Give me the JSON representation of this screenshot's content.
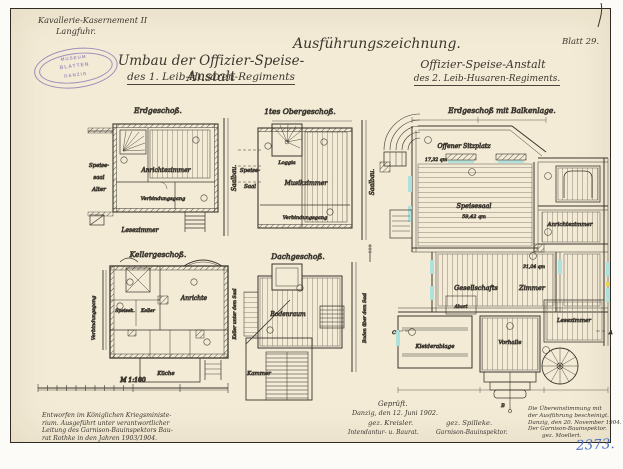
{
  "page": {
    "inventory_number": "2373.",
    "sheet_label": "Blatt 29."
  },
  "header": {
    "site_line1": "Kavallerie-Kasernement II",
    "site_line2": "Langfuhr.",
    "title_left_line1": "Umbau der Offizier-Speise-Anstalt",
    "title_left_line2": "des 1. Leib-Husaren-Regiments",
    "title_right_top": "Ausführungszeichnung.",
    "title_right_line1": "Offizier-Speise-Anstalt",
    "title_right_line2": "des 2. Leib-Husaren-Regiments."
  },
  "stamp": {
    "line_top": "MUSEUM",
    "line_mid": "BLATTEN",
    "line_bottom": "DANZIG"
  },
  "plans": {
    "erdgeschoss": {
      "title": "Erdgeschoß.",
      "label_speise": "Speise-",
      "label_saal": "saal",
      "label_alter": "Alter",
      "room_anrichte": "Anrichtezimmer",
      "room_verbindungsgang": "Verbindungsgang",
      "label_saalbau": "Saalbau.",
      "label_lesezimmer": "Lesezimmer"
    },
    "obergeschoss": {
      "title": "1tes Obergeschoß.",
      "label_speise": "Speise-",
      "label_saal": "Saal",
      "room_loggia": "Loggia",
      "room_musikzimmer": "Musikzimmer",
      "room_verbindungsgang": "Verbindungsgang",
      "label_saalbau": "Saalbau."
    },
    "kellergeschoss": {
      "title": "Kellergeschoß.",
      "label_verbindungsgang": "Verbindungsgang",
      "room_speisekammer": "Speisek.",
      "room_keller": "Keller",
      "room_anrichte": "Anrichte",
      "label_keller_saal": "Keller unter dem Saal",
      "room_kueche": "Küche"
    },
    "dachgeschoss": {
      "title": "Dachgeschoß.",
      "room_bodenraum": "Bodenraum",
      "label_boden_saal": "Boden über dem Saal",
      "room_kammer": "Kammer"
    },
    "hauptplan": {
      "title": "Erdgeschoß mit Balkenlage.",
      "room_sitzplatz": "Offener Sitzplatz",
      "area_sitzplatz": "17,32 qm",
      "room_speisesaal": "Speisesaal",
      "area_speisesaal": "59,42 qm",
      "room_anrichtezimmer": "Anrichtezimmer",
      "room_gesellschaft_1": "Gesellschafts",
      "room_gesellschaft_2": "Zimmer",
      "area_gesellschaft": "31,04 qm",
      "room_abort": "Abort",
      "room_vorhalle": "Vorhalle",
      "room_lesezimmer": "Lesezimmer",
      "room_kleiderablage": "Kleiderablage",
      "section_a": "A",
      "section_b": "B",
      "section_c": "C"
    }
  },
  "scale_bar": {
    "label": "M 1:100"
  },
  "footer": {
    "note_line1": "Entworfen im Königlichen Kriegsministe-",
    "note_line2": "rium. Ausgeführt unter verantwortlicher",
    "note_line3": "Leitung des Garnison-Bauinspektors Bau-",
    "note_line4": "rat Rothke in den Jahren 1903/1904.",
    "approval_title": "Geprüft.",
    "approval_place_date": "Danzig, den 12. Juni 1902.",
    "signature_1": "gez. Kreisler.",
    "signature_1_role": "Intendantur- u. Baurat.",
    "signature_2": "gez. Spilleke.",
    "signature_2_role": "Garnison-Bauinspektor.",
    "cert_line1": "Die Übereinstimmung mit",
    "cert_line2": "der Ausführung bescheinigt.",
    "cert_line3": "Danzig, den 20. November 1904.",
    "cert_line4": "Der Garnison-Bauinspektor.",
    "cert_line5": "gez. Moellert."
  },
  "colors": {
    "paper": "#f3ebd6",
    "ink": "#3b362e",
    "stamp_purple": "#8a76b4",
    "inventory_blue": "#4b6fc2",
    "window_cyan": "#aee0dc"
  }
}
